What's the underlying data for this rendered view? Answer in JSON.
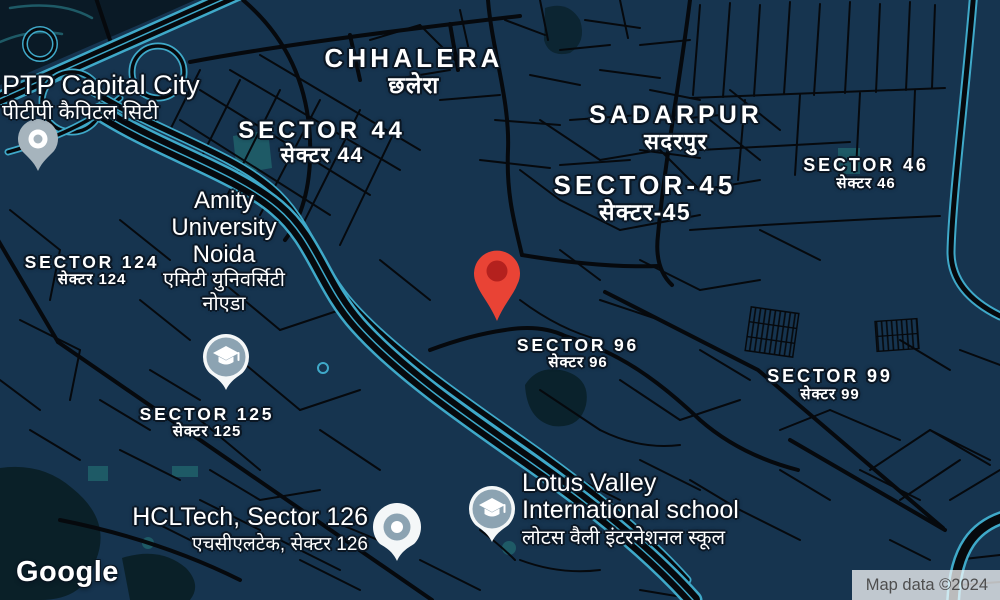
{
  "palette": {
    "background": "#16344F",
    "road": "#06090D",
    "road_highlight": "#3FA9C9",
    "park": "#0A2028",
    "water": "#0A222C",
    "teal_area": "#1E5A66",
    "dark_corner": "#0A1A26",
    "marker_red": "#E94335",
    "marker_red_inner": "#B4211E",
    "pin_gray": "#A6B4BD",
    "pin_blue_gray": "#8CA3B2",
    "pin_white": "#F4F7F8"
  },
  "icons": {
    "destination": "map-marker-icon",
    "school": "graduation-cap-icon",
    "place": "poi-dot-icon"
  },
  "area_labels": [
    {
      "id": "chhalera",
      "en": "CHHALERA",
      "hi": "छलेरा"
    },
    {
      "id": "sector-44",
      "en": "SECTOR 44",
      "hi": "सेक्टर 44"
    },
    {
      "id": "sadarpur",
      "en": "SADARPUR",
      "hi": "सदरपुर"
    },
    {
      "id": "sector-45",
      "en": "SECTOR-45",
      "hi": "सेक्टर-45"
    },
    {
      "id": "sector-46",
      "en": "SECTOR 46",
      "hi": "सेक्टर 46"
    },
    {
      "id": "sector-96",
      "en": "SECTOR 96",
      "hi": "सेक्टर 96"
    },
    {
      "id": "sector-99",
      "en": "SECTOR 99",
      "hi": "सेक्टर 99"
    },
    {
      "id": "sector-124",
      "en": "SECTOR 124",
      "hi": "सेक्टर 124"
    },
    {
      "id": "sector-125",
      "en": "SECTOR 125",
      "hi": "सेक्टर 125"
    }
  ],
  "pois": [
    {
      "id": "ptp",
      "en": "PTP Capital City",
      "hi": "पीटीपी कैपिटल सिटी"
    },
    {
      "id": "amity",
      "en": "Amity University Noida",
      "hi": "एमिटी युनिवर्सिटी नोएडा"
    },
    {
      "id": "hcltech",
      "en": "HCLTech, Sector 126",
      "hi": "एचसीएलटेक, सेक्टर 126"
    },
    {
      "id": "lotus",
      "en": "Lotus Valley International school",
      "hi": "लोटस वैली इंटरनेशनल स्कूल"
    }
  ],
  "branding": {
    "logo": "Google"
  },
  "attribution": {
    "text": "Map data ©2024"
  }
}
